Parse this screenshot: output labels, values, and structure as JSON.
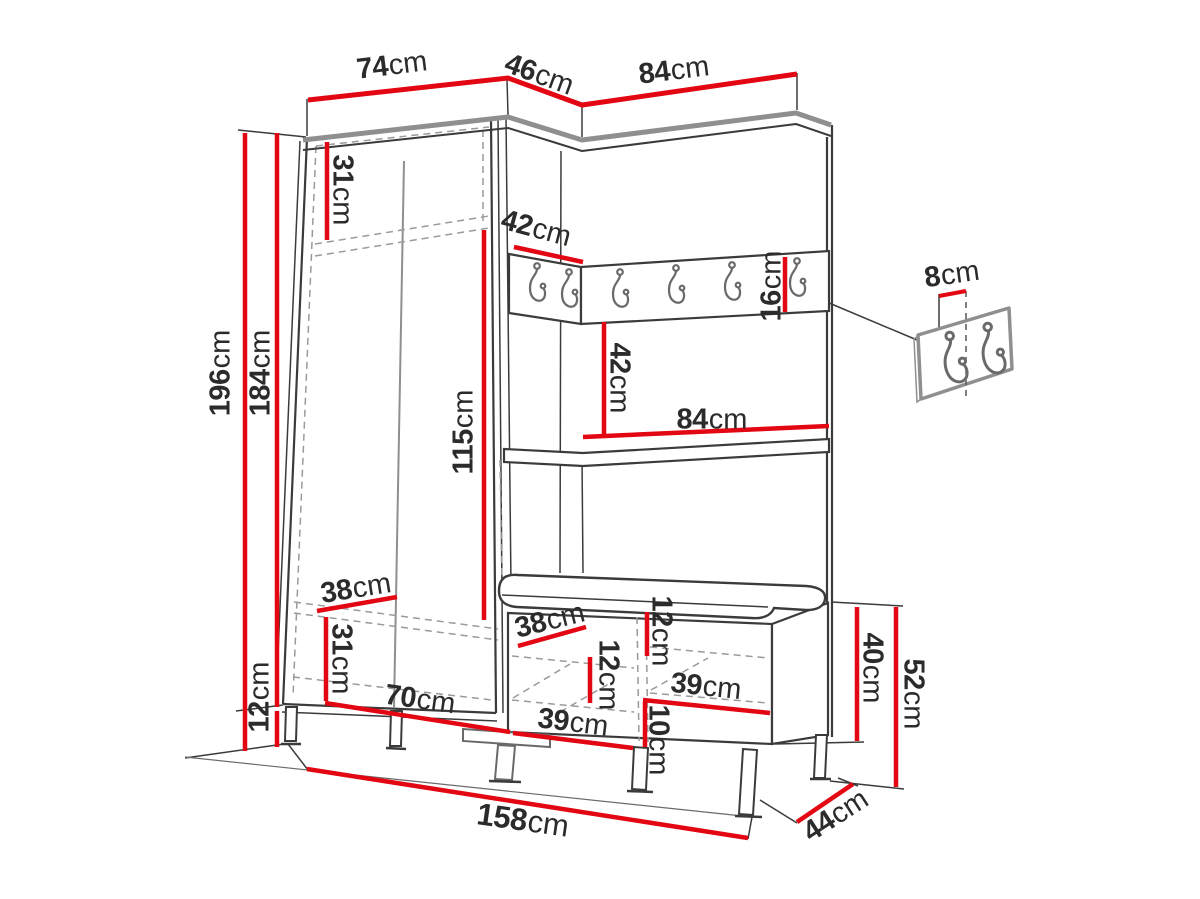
{
  "figure": {
    "kind": "furniture dimension diagram",
    "unit": "cm"
  },
  "colors": {
    "dimension_red": "#e30613",
    "outline_dark": "#3b3b3b",
    "panel_gray": "#8f8f8f"
  },
  "dims": {
    "top_left_width": {
      "value": "74",
      "unit": "cm"
    },
    "top_corner_width": {
      "value": "46",
      "unit": "cm"
    },
    "top_right_width": {
      "value": "84",
      "unit": "cm"
    },
    "upper_shelf_height": {
      "value": "31",
      "unit": "cm"
    },
    "total_height": {
      "value": "196",
      "unit": "cm"
    },
    "body_height": {
      "value": "184",
      "unit": "cm"
    },
    "corner_rail_width": {
      "value": "42",
      "unit": "cm"
    },
    "hook_rail_height": {
      "value": "16",
      "unit": "cm"
    },
    "hook_spacing": {
      "value": "8",
      "unit": "cm"
    },
    "niche_height": {
      "value": "42",
      "unit": "cm"
    },
    "interior_height": {
      "value": "115",
      "unit": "cm"
    },
    "shelf_width": {
      "value": "84",
      "unit": "cm"
    },
    "wardrobe_depth_lower": {
      "value": "38",
      "unit": "cm"
    },
    "lower_compartment_height": {
      "value": "31",
      "unit": "cm"
    },
    "leg_height": {
      "value": "12",
      "unit": "cm"
    },
    "wardrobe_interior_width": {
      "value": "70",
      "unit": "cm"
    },
    "bench_depth": {
      "value": "38",
      "unit": "cm"
    },
    "bench_upper_gap": {
      "value": "12",
      "unit": "cm"
    },
    "bench_left_gap": {
      "value": "12",
      "unit": "cm"
    },
    "bench_right_width": {
      "value": "39",
      "unit": "cm"
    },
    "bench_lower_gap": {
      "value": "10",
      "unit": "cm"
    },
    "bench_left_width": {
      "value": "39",
      "unit": "cm"
    },
    "bench_body_height": {
      "value": "40",
      "unit": "cm"
    },
    "bench_total_height": {
      "value": "52",
      "unit": "cm"
    },
    "bench_total_depth": {
      "value": "44",
      "unit": "cm"
    },
    "total_width": {
      "value": "158",
      "unit": "cm"
    }
  }
}
